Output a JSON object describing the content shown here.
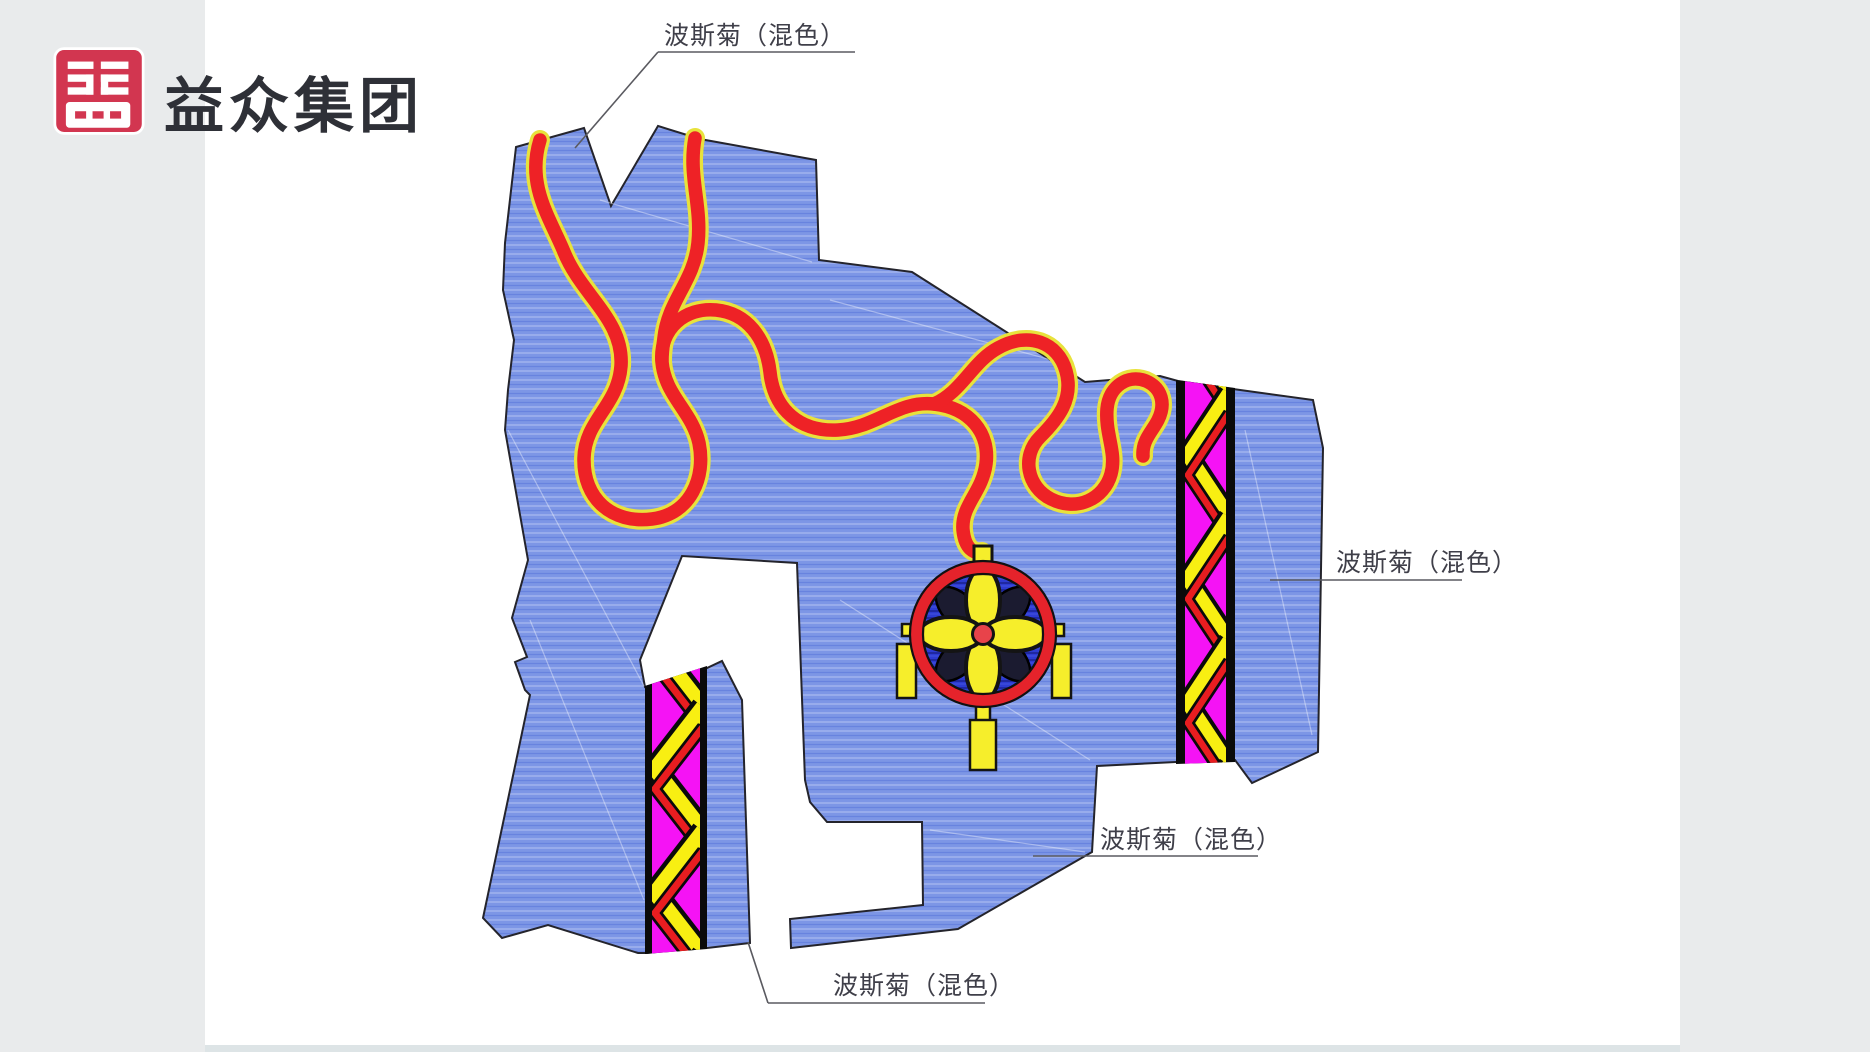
{
  "brand": {
    "name": "益众集团"
  },
  "logo": {
    "bg_color": "#d23650",
    "glyph": "seal-style-monogram-icon"
  },
  "canvas": {
    "background": "#e9ebec",
    "page_color": "#ffffff"
  },
  "plan": {
    "area_fill": "#7d96e6",
    "outline_color": "#24242c",
    "ribbon": {
      "color": "#ee2226",
      "edge_color": "#e8e23c"
    },
    "chevron_band": {
      "magenta": "#f513f5",
      "yellow": "#f8ef12",
      "red": "#e81d20",
      "border": "#0a0a0a"
    },
    "medallion": {
      "disc": "#2d3bd2",
      "ring": "#e5232b",
      "petal": "#f6ee2b",
      "center": "#e8434a"
    }
  },
  "labels": {
    "top": "波斯菊（混色）",
    "right": "波斯菊（混色）",
    "middle": "波斯菊（混色）",
    "bottom": "波斯菊（混色）"
  }
}
